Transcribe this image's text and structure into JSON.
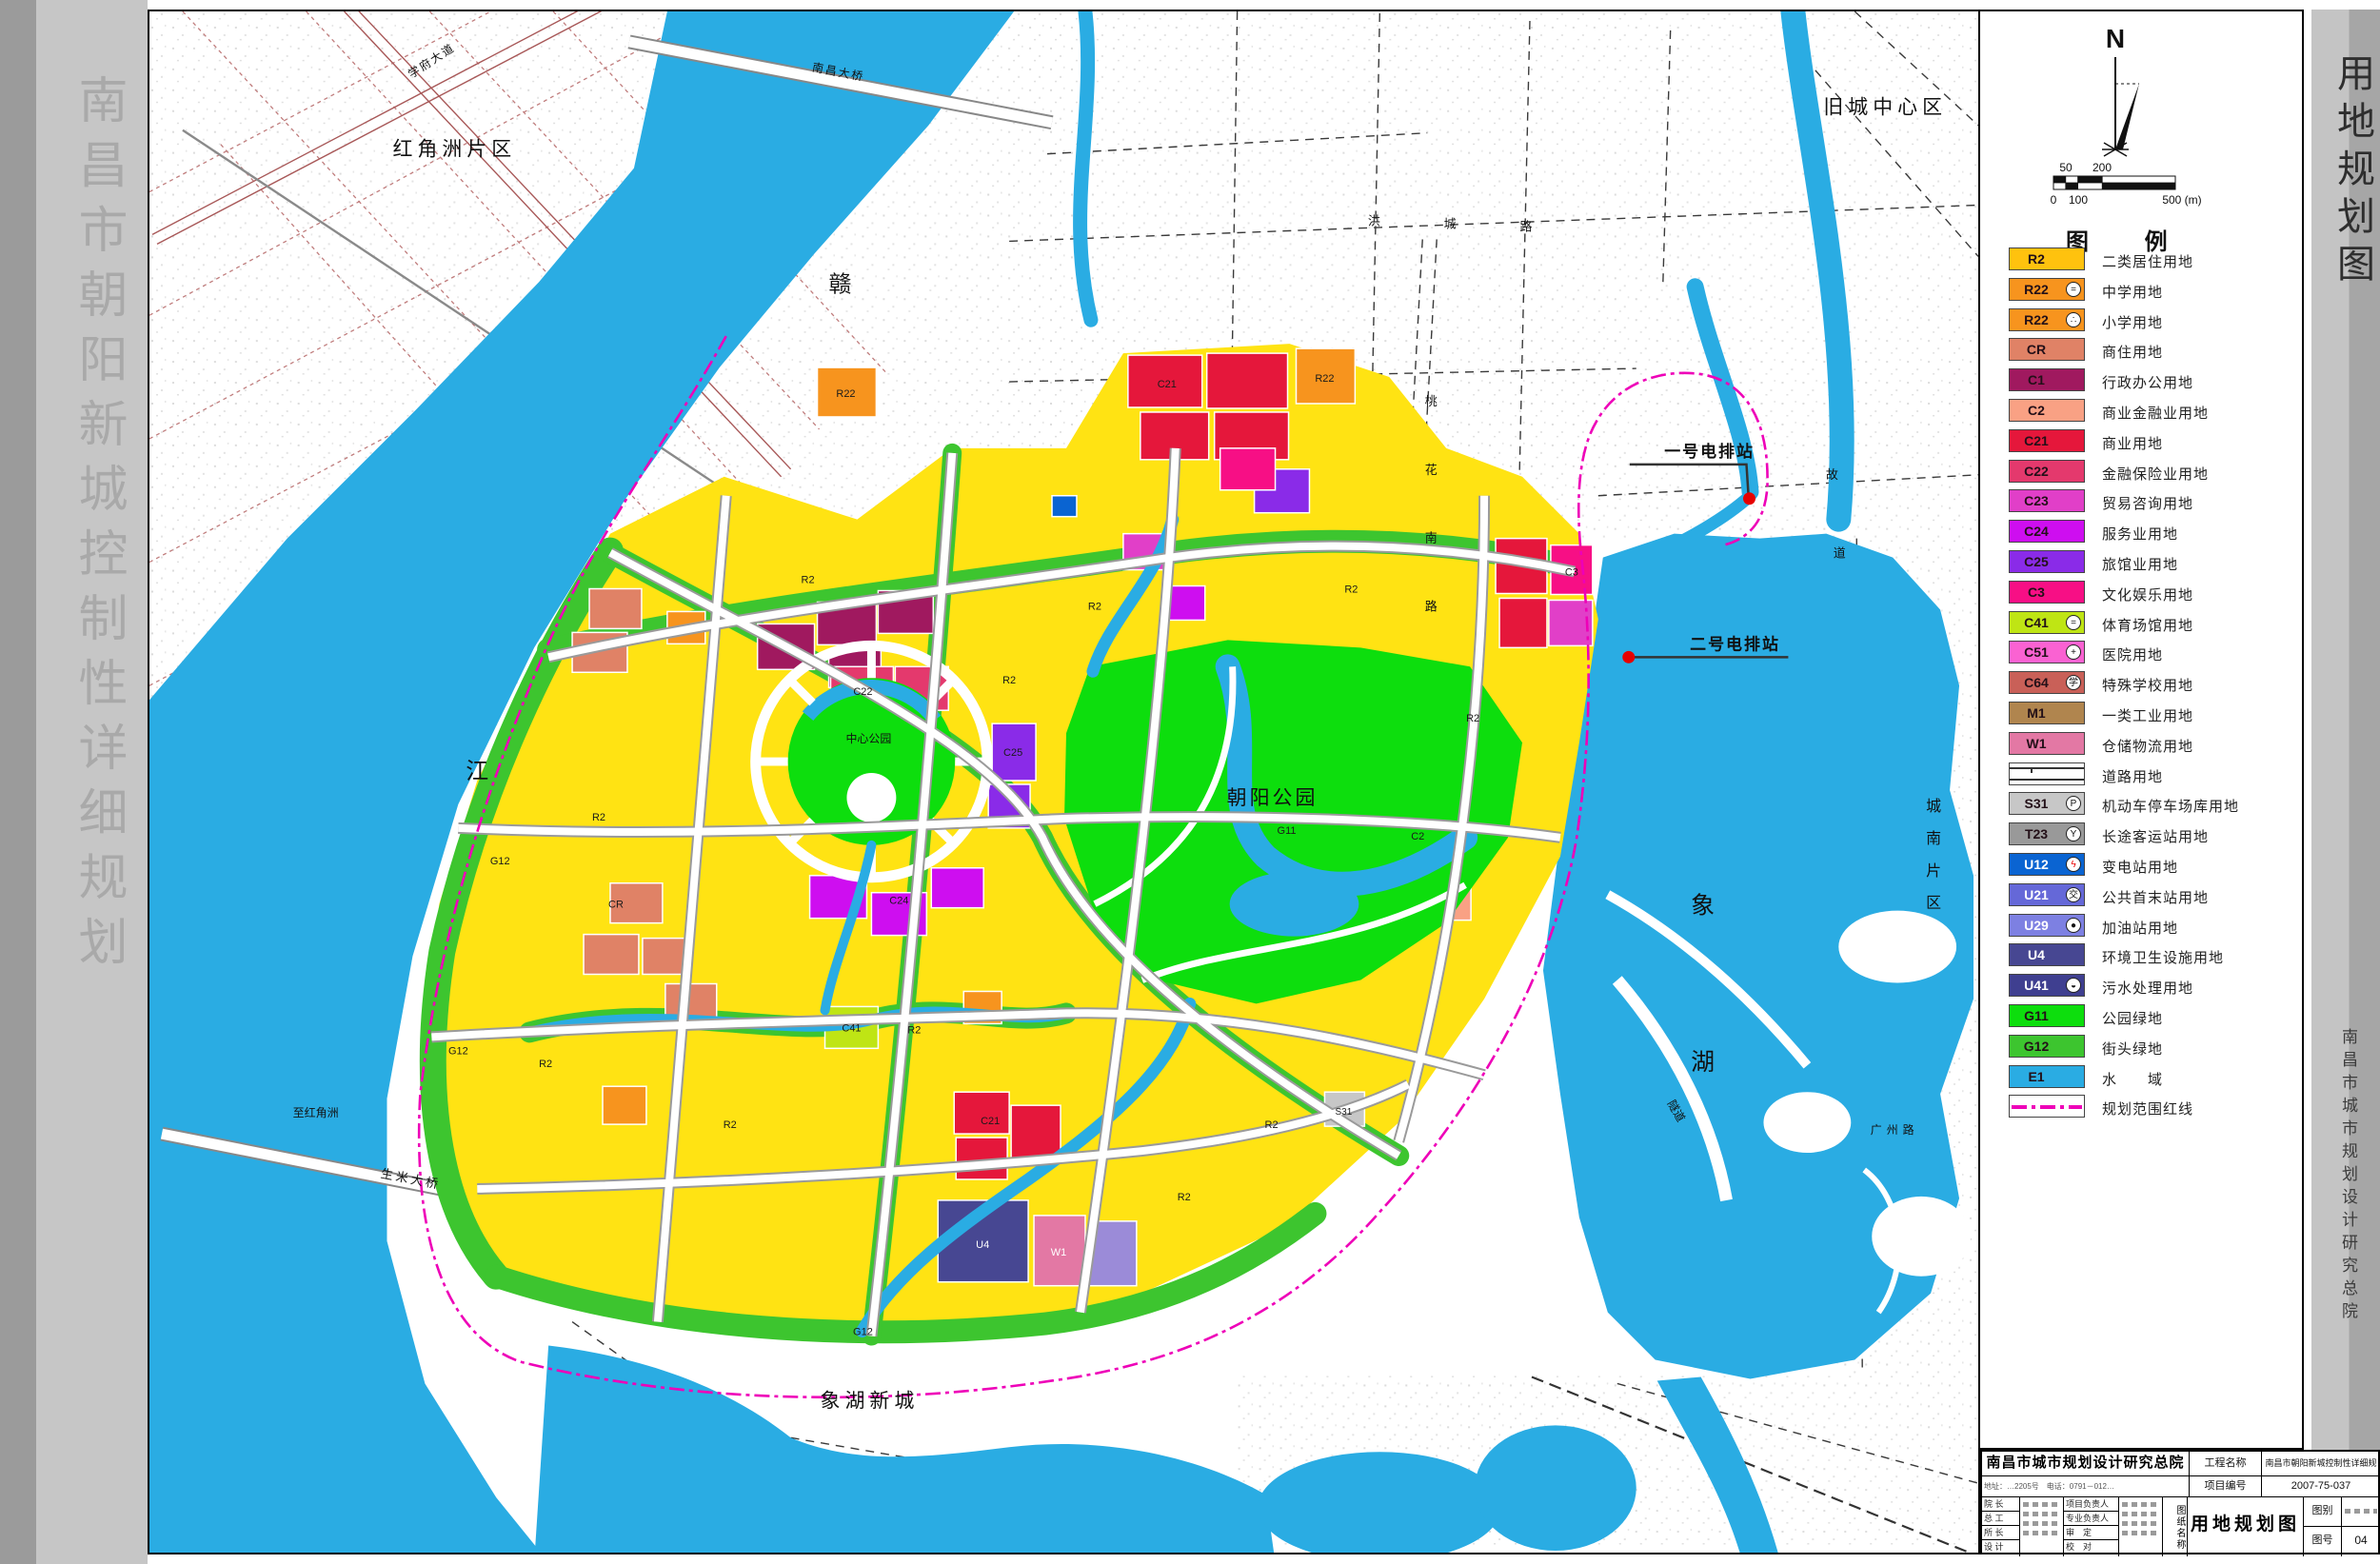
{
  "sidebar": {
    "title": "南昌市朝阳新城控制性详细规划"
  },
  "right_strip": {
    "title": "用地规划图",
    "institute": "南昌市城市规划设计研究总院"
  },
  "north": {
    "label": "N"
  },
  "scale_bar": {
    "top_ticks": [
      "50",
      "200"
    ],
    "bottom_ticks": [
      "0",
      "100",
      "500 (m)"
    ]
  },
  "legend": {
    "header": "图  例",
    "items": [
      {
        "code": "R2",
        "color": "#FFC20E",
        "label": "二类居住用地"
      },
      {
        "code": "R22",
        "color": "#F7941E",
        "symbol": "=",
        "label": "中学用地"
      },
      {
        "code": "R22",
        "color": "#F7941E",
        "symbol": "∴",
        "label": "小学用地"
      },
      {
        "code": "CR",
        "color": "#E08266",
        "label": "商住用地"
      },
      {
        "code": "C1",
        "color": "#A0195F",
        "label": "行政办公用地"
      },
      {
        "code": "C2",
        "color": "#F9A184",
        "label": "商业金融业用地"
      },
      {
        "code": "C21",
        "color": "#E5173B",
        "label": "商业用地"
      },
      {
        "code": "C22",
        "color": "#E4396D",
        "label": "金融保险业用地"
      },
      {
        "code": "C23",
        "color": "#E13FC8",
        "label": "贸易咨询用地"
      },
      {
        "code": "C24",
        "color": "#CE0EF0",
        "label": "服务业用地"
      },
      {
        "code": "C25",
        "color": "#8A2BE8",
        "label": "旅馆业用地"
      },
      {
        "code": "C3",
        "color": "#F70F85",
        "label": "文化娱乐用地"
      },
      {
        "code": "C41",
        "color": "#BFE514",
        "symbol": "=",
        "label": "体育场馆用地"
      },
      {
        "code": "C51",
        "color": "#FA62D2",
        "symbol": "+",
        "label": "医院用地"
      },
      {
        "code": "C64",
        "color": "#C96058",
        "symbol": "学",
        "label": "特殊学校用地"
      },
      {
        "code": "M1",
        "color": "#B0854E",
        "label": "一类工业用地"
      },
      {
        "code": "W1",
        "color": "#E378A4",
        "label": "仓储物流用地"
      },
      {
        "type": "road",
        "label": "道路用地"
      },
      {
        "code": "S31",
        "color": "#C7C7C7",
        "symbol": "P",
        "label": "机动车停车场库用地"
      },
      {
        "code": "T23",
        "color": "#999999",
        "symbol": "Y",
        "label": "长途客运站用地"
      },
      {
        "code": "U12",
        "color": "#0A64D2",
        "symbol": "ϟ",
        "symbol_color": "#E80000",
        "text": "#ffffff",
        "label": "变电站用地"
      },
      {
        "code": "U21",
        "color": "#6568D8",
        "symbol": "交",
        "text": "#ffffff",
        "label": "公共首末站用地"
      },
      {
        "code": "U29",
        "color": "#7D80E2",
        "symbol": "●",
        "text": "#ffffff",
        "label": "加油站用地"
      },
      {
        "code": "U4",
        "color": "#474792",
        "text": "#ffffff",
        "label": "环境卫生设施用地"
      },
      {
        "code": "U41",
        "color": "#3F3F90",
        "symbol": "◒",
        "text": "#ffffff",
        "label": "污水处理用地"
      },
      {
        "code": "G11",
        "color": "#0DDE0D",
        "label": "公园绿地"
      },
      {
        "code": "G12",
        "color": "#3DC52F",
        "label": "街头绿地"
      },
      {
        "code": "E1",
        "color": "#2AACE3",
        "label": "水　　域"
      },
      {
        "type": "boundary",
        "label": "规划范围红线"
      }
    ]
  },
  "map": {
    "labels": {
      "hongjiaozhou": "红角洲片区",
      "jiucheng": "旧城中心区",
      "xianghu_xincheng": "象湖新城",
      "chaoyang_park": "朝阳公园",
      "zhongxin_park": "中心公园",
      "gan": "赣",
      "jiang": "江",
      "xiang": "象",
      "hu": "湖",
      "chengnan": [
        "城",
        "南",
        "片",
        "区"
      ],
      "taohua": [
        "桃",
        "花",
        "南",
        "路"
      ],
      "hongcheng": [
        "洪",
        "城",
        "路"
      ],
      "gudao": [
        "故",
        "道"
      ],
      "guangzhou_rd": "广州路",
      "xuefu_ave": "学府大道",
      "nanchang_bridge": "南昌大桥",
      "shengmi_bridge": "生米大桥",
      "zhi_hongjiaozhou": "至红角洲",
      "suidao": "隧道",
      "pump1": "一号电排站",
      "pump2": "二号电排站"
    },
    "parcel_codes": [
      "R2",
      "R2",
      "R2",
      "R2",
      "R2",
      "R2",
      "R2",
      "R2",
      "R2",
      "R2",
      "R2",
      "G12",
      "G12",
      "G12",
      "G11",
      "C21",
      "C21",
      "C22",
      "C24",
      "C25",
      "CR",
      "C2",
      "C3",
      "C41",
      "U4",
      "W1",
      "R22",
      "R22",
      "S31"
    ]
  },
  "title_block": {
    "institute": "南昌市城市规划设计研究总院",
    "project_label": "工程名称",
    "project_name": "南昌市朝阳新城控制性详细规划",
    "address_line": "地址：…2205号　电话：0791－012…",
    "number_label": "项目编号",
    "number_value": "2007-75-037",
    "roles_col1": [
      "院 长",
      "总 工",
      "所 长",
      "设 计"
    ],
    "roles_col2": [
      "项目负责人",
      "专业负责人",
      "审　定",
      "校　对"
    ],
    "drawing_label": "图纸名称",
    "drawing_name": "用地规划图",
    "sheet_type_label": "图别",
    "sheet_no_label": "图号",
    "sheet_no_value": "04"
  },
  "colors": {
    "water": "#2AACE3",
    "park_green": "#0DDE0D",
    "street_green": "#3DC52F",
    "residential_yellow": "#FFE313",
    "boundary_magenta": "#EE00B8",
    "pump_dot_red": "#E60000"
  }
}
